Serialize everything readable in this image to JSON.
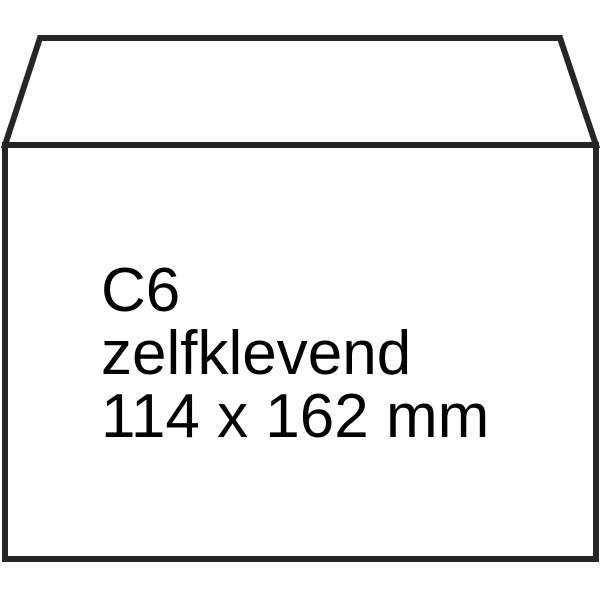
{
  "envelope": {
    "label": {
      "size": "C6",
      "adhesive": "zelfklevend",
      "dimensions": "114 x 162 mm"
    },
    "colors": {
      "background": "#ffffff",
      "outline": "#262626",
      "paper": "#ffffff",
      "text": "#000000"
    }
  }
}
